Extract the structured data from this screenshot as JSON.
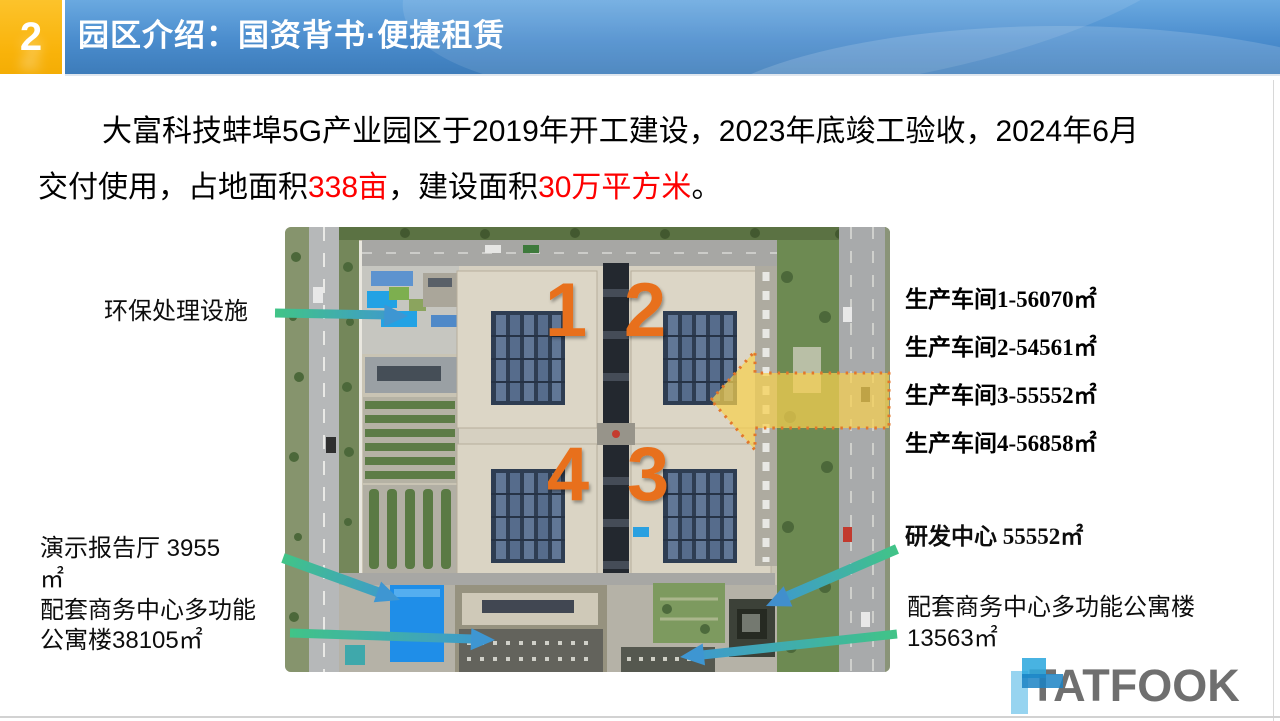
{
  "header": {
    "badge": "2",
    "title": "园区介绍：国资背书·便捷租赁"
  },
  "intro": {
    "line1": "大富科技蚌埠5G产业园区于2019年开工建设，2023年底竣工验收，2024年6月",
    "line2_pre": "交付使用，占地面积",
    "red1": "338亩",
    "mid": "，建设面积",
    "red2": "30万平方米",
    "end": "。"
  },
  "map": {
    "numbers": {
      "n1": "1",
      "n2": "2",
      "n3": "3",
      "n4": "4"
    },
    "number_color": "#e8701a",
    "callouts_left": [
      {
        "id": "environment-facility",
        "lines": [
          "环保处理设施"
        ]
      },
      {
        "id": "demo-hall",
        "lines": [
          "演示报告厅 3955",
          "㎡"
        ]
      },
      {
        "id": "apartment-west",
        "lines": [
          "配套商务中心多功能",
          "公寓楼38105㎡"
        ]
      }
    ],
    "callouts_right": [
      {
        "id": "workshop-1",
        "text": "生产车间1-56070㎡"
      },
      {
        "id": "workshop-2",
        "text": "生产车间2-54561㎡"
      },
      {
        "id": "workshop-3",
        "text": "生产车间3-55552㎡"
      },
      {
        "id": "workshop-4",
        "text": "生产车间4-56858㎡"
      },
      {
        "id": "rd-center",
        "text": "研发中心 55552㎡"
      }
    ],
    "callout_apartment_east": {
      "lines": [
        "配套商务中心多功能公寓楼",
        "13563㎡"
      ]
    }
  },
  "colors": {
    "header_blue": "#4a8ccd",
    "badge_orange": "#f9b30a",
    "highlight_red": "#fe0000",
    "arrow_green": "#41c487",
    "arrow_blue": "#3e96d2",
    "highlight_yellow": "#f7d04f",
    "yellow_arrow_border": "#e2762a"
  },
  "logo": {
    "text": "TATFOOK"
  }
}
